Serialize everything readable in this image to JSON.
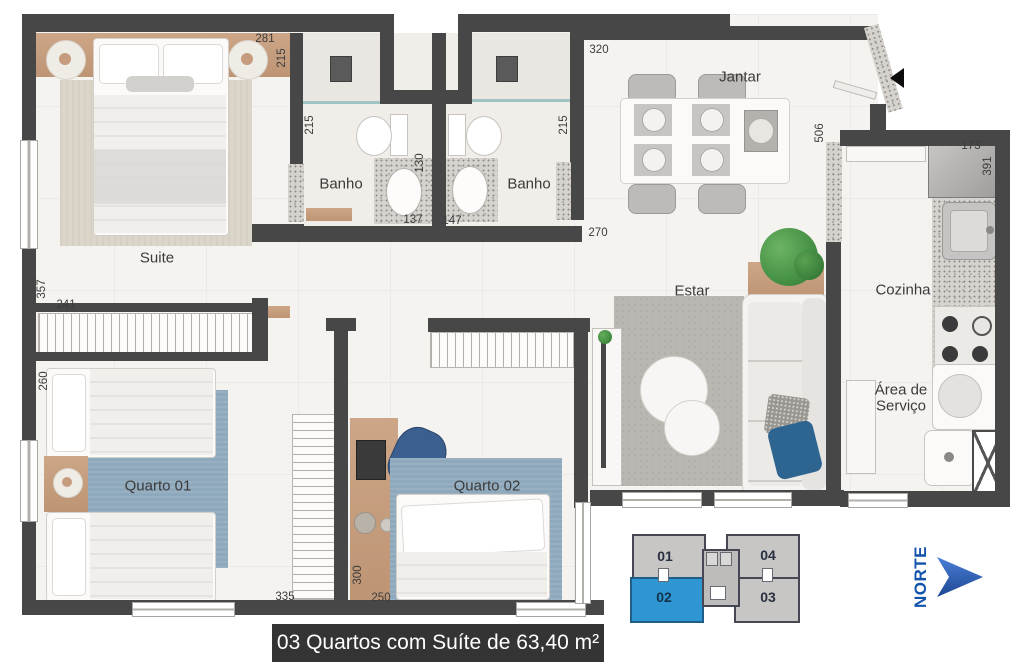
{
  "caption": "03 Quartos com Suíte de 63,40 m²",
  "compass": {
    "label": "NORTE"
  },
  "rooms": {
    "suite": "Suite",
    "banho1": "Banho",
    "banho2": "Banho",
    "jantar": "Jantar",
    "cozinha": "Cozinha",
    "area_servico_l1": "Área de",
    "area_servico_l2": "Serviço",
    "estar": "Estar",
    "quarto1": "Quarto 01",
    "quarto2": "Quarto 02"
  },
  "dimensions": {
    "suite_headboard": "281",
    "suite_side": "215",
    "banho1_side": "215",
    "banho1_inner": "130",
    "banho1_width": "137",
    "banho2_width": "147",
    "banho2_side": "215",
    "jantar_top": "320",
    "hall_opening": "270",
    "jantar_side": "506",
    "fridge_width": "173",
    "cozinha_side": "391",
    "suite_left": "357",
    "closet_width": "241",
    "quarto1_left": "260",
    "quarto1_bottom": "335",
    "quarto2_desk": "300",
    "quarto2_bottom": "250"
  },
  "keyplan": {
    "units": [
      {
        "id": "01",
        "highlighted": false
      },
      {
        "id": "02",
        "highlighted": true
      },
      {
        "id": "03",
        "highlighted": false
      },
      {
        "id": "04",
        "highlighted": false
      }
    ]
  },
  "colors": {
    "wall": "#474747",
    "keyplan_highlight": "#2d96d3",
    "north_blue": "#1353ac",
    "caption_bg": "#343434",
    "rug_blue": "#8fa9bc"
  }
}
